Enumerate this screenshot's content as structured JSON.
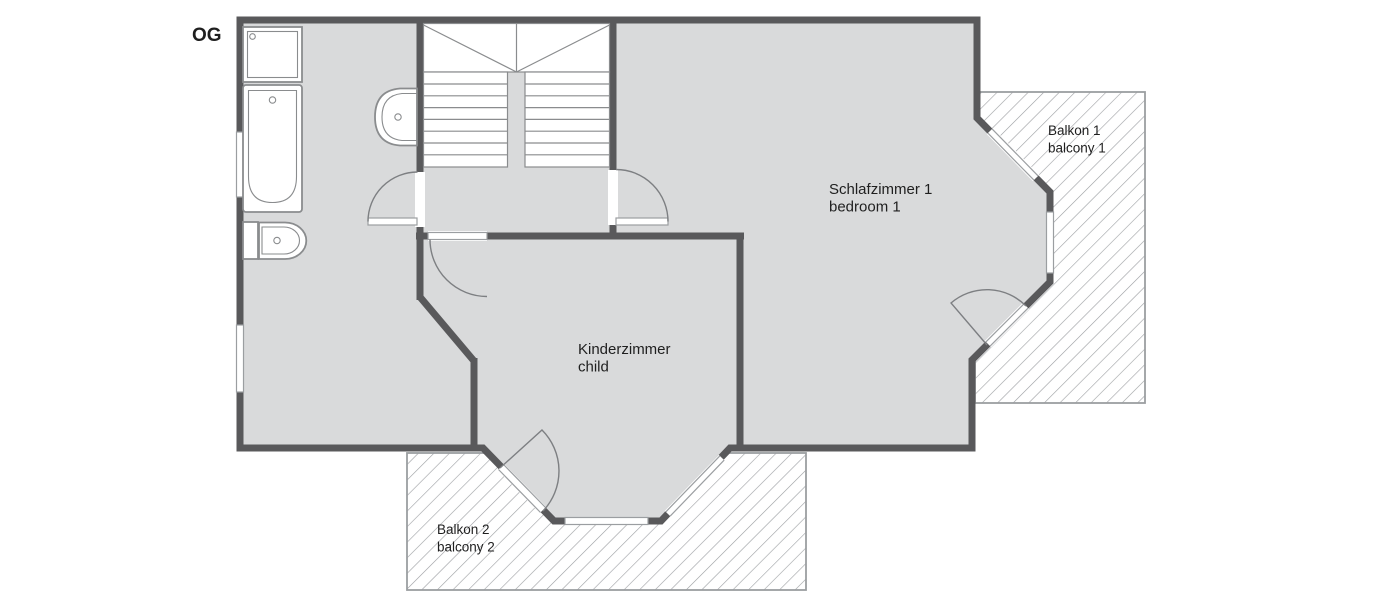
{
  "floor_label": "OG",
  "rooms": {
    "bedroom1": {
      "name_de": "Schlafzimmer 1",
      "name_en": "bedroom 1"
    },
    "child": {
      "name_de": "Kinderzimmer",
      "name_en": "child"
    },
    "balcony1": {
      "name_de": "Balkon 1",
      "name_en": "balcony 1"
    },
    "balcony2": {
      "name_de": "Balkon 2",
      "name_en": "balcony 2"
    }
  },
  "colors": {
    "background": "#ffffff",
    "wall": "#59595b",
    "floor": "#d9dadb",
    "fixture_outline": "#8a8c8e",
    "fixture_fill": "#ffffff",
    "thin_line": "#7d7f82",
    "hatch": "#9b9ea1",
    "balcony_border": "#9b9ea1",
    "window_border": "#9b9ea1",
    "text": "#1f1f1f"
  }
}
